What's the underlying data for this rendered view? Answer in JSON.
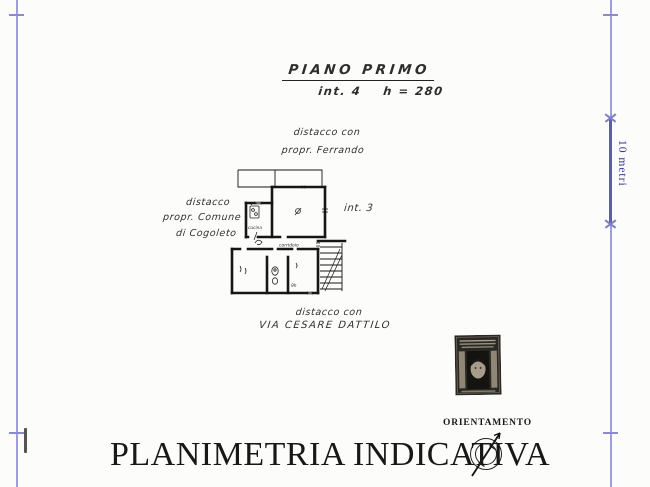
{
  "document": {
    "type": "scanned cadastral floor plan",
    "background_color": "#fcfcfa",
    "ink_color": "#1f1f1f",
    "frame_color": "#8d8dd0",
    "scale_text_color": "#3a3a92"
  },
  "header": {
    "title": "PIANO PRIMO",
    "subtitle": "int. 4    h = 280"
  },
  "boundaries": {
    "top": [
      "distacco con",
      "propr. Ferrando"
    ],
    "left": [
      "distacco",
      "propr. Comune",
      "di Cogoleto"
    ],
    "bottom": [
      "distacco con",
      "VIA CESARE DATTILO"
    ],
    "adjacent_unit": "int. 3"
  },
  "plan_labels": {
    "kitchen": "cucina",
    "corridor": "corridoio",
    "room_note": "9h"
  },
  "scale": {
    "label": "10 metri"
  },
  "orientation": {
    "label": "ORIENTAMENTO",
    "icon": "compass-north-arrow-icon"
  },
  "stamp": {
    "icon": "revenue-stamp-portrait-icon"
  },
  "footer": {
    "title": "PLANIMETRIA INDICATIVA"
  }
}
